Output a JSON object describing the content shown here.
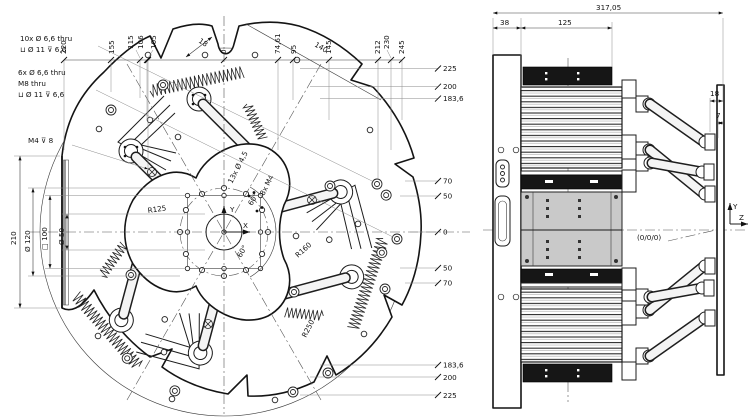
{
  "drawing": {
    "front_view": {
      "dims_top": [
        "220",
        "155",
        "115",
        "106",
        "105",
        "0",
        "74,61",
        "95",
        "145",
        "212",
        "230",
        "245"
      ],
      "dims_right": [
        "225",
        "200",
        "183,6",
        "70",
        "50",
        "0",
        "50",
        "70",
        "183,6",
        "200",
        "225"
      ],
      "dim_left": "210",
      "dim_circle_120": "Ø 120",
      "dim_square_100": "□ 100",
      "dim_circle_50": "Ø 50",
      "radius_r125": "R125",
      "radius_r160": "R160",
      "radius_r250": "R250",
      "diag_dim_18": "18",
      "diag_dim_140": "140",
      "angle_upper": "60°",
      "angle_lower": "60°",
      "note_counterbore_l1": "10x  Ø 6,6 thru",
      "note_counterbore_l2": "⊔ Ø 11 ⊽ 6,6",
      "note_thread_l1": "6x  Ø 6,6 thru",
      "note_thread_l2": "M8 thru",
      "note_thread_l3": "⊔ Ø 11 ⊽ 6,6",
      "note_m4": "M4 ⊽ 8",
      "note_holes_circle": "13x  Ø 4,5",
      "note_holes_square": "8x M4",
      "axis_x": "X",
      "axis_y": "Y"
    },
    "side_view": {
      "dim_total": "317,05",
      "dim_plate": "38",
      "dim_housing": "125",
      "dim_offset": "18",
      "dim_gap": "7",
      "origin_label": "(0/0/0)",
      "axis_y": "Y",
      "axis_z": "Z"
    }
  }
}
